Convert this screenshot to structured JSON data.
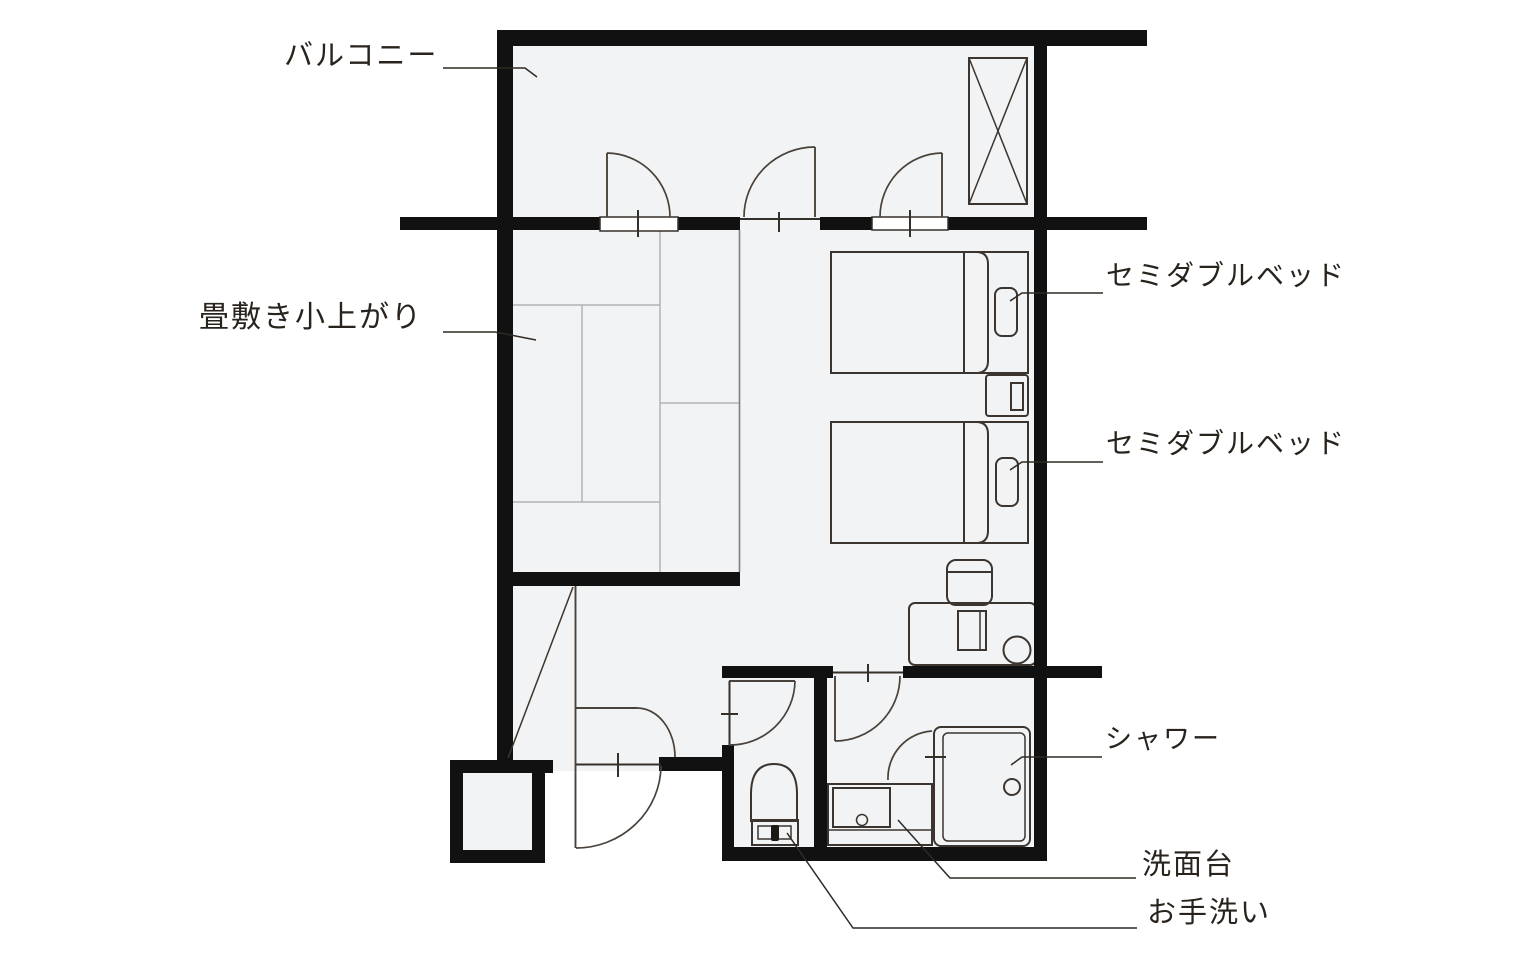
{
  "diagram": {
    "type": "hotel-guest-room-floor-plan",
    "labels": {
      "balcony": "バルコニー",
      "tatami": "畳敷き小上がり",
      "bed_top": "セミダブルベッド",
      "bed_bottom": "セミダブルベッド",
      "shower": "シャワー",
      "washbasin": "洗面台",
      "toilet": "お手洗い"
    },
    "colors": {
      "wall": "#111111",
      "floor": "#f2f3f4",
      "fixture_line": "#3c352f",
      "label_text": "#29231d",
      "tatami_line": "#b3b3b3"
    }
  }
}
